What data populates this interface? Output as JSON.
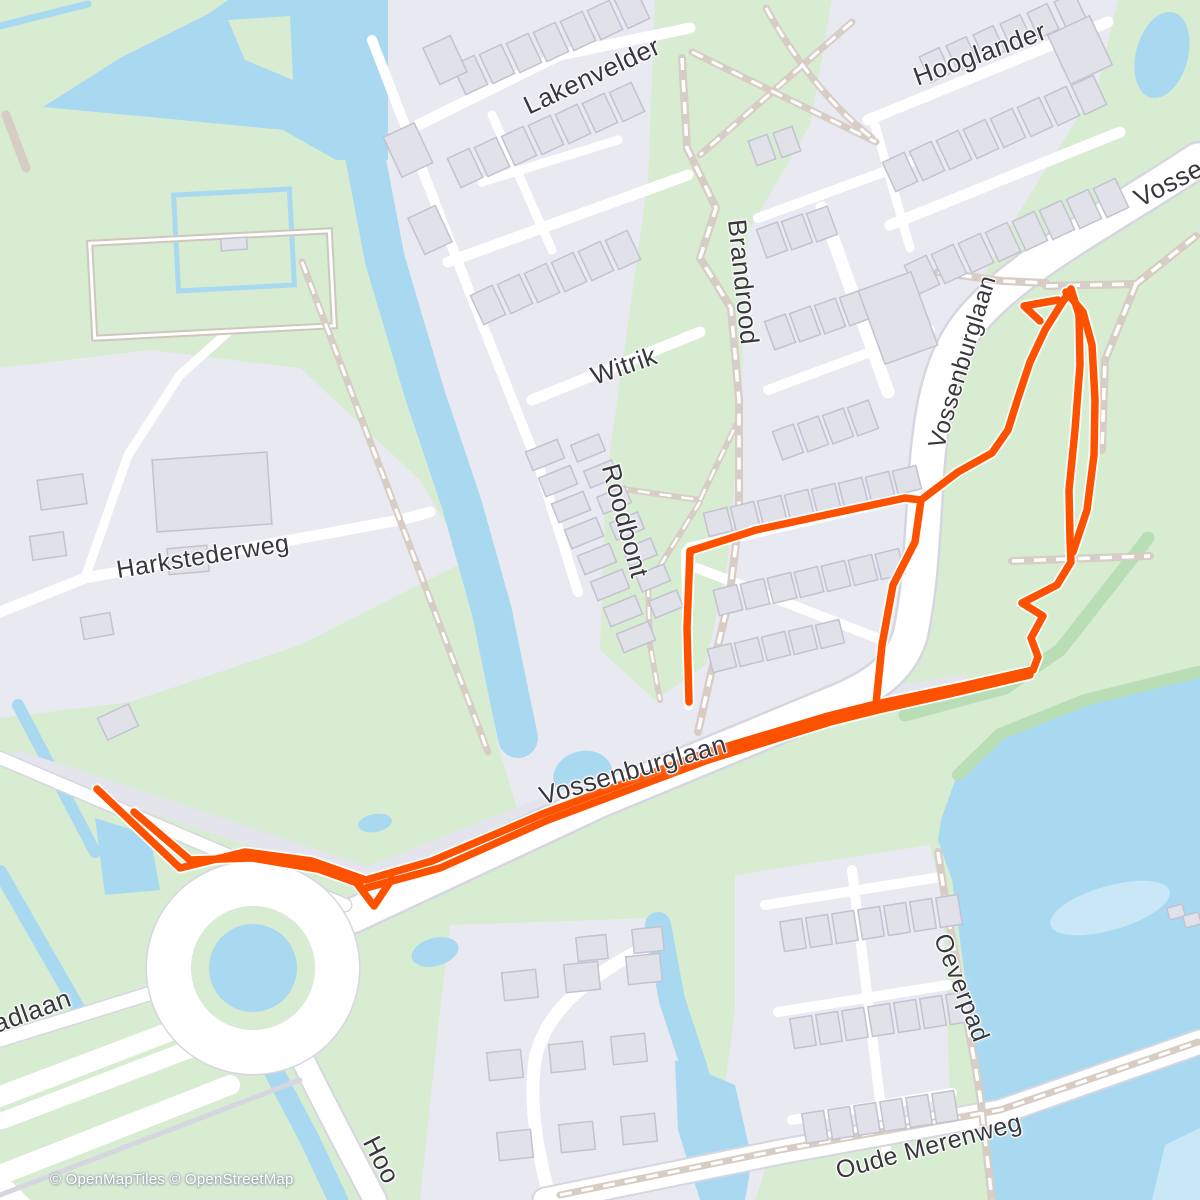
{
  "map": {
    "attribution": "© OpenMapTiles © OpenStreetMap",
    "labels": {
      "lakenvelder": "Lakenvelder",
      "hooglander": "Hooglander",
      "vossenburglaan_top": "Vossenburglaan",
      "brandrood": "Brandrood",
      "witrik": "Witrik",
      "vossenburglaan_mid": "Vossenburglaan",
      "roodbont": "Roodbont",
      "harkstederweg": "Harkstederweg",
      "vossenburglaan_main": "Vossenburglaan",
      "oeverpad": "Oeverpad",
      "oude_merenweg": "Oude Merenweg",
      "adlaan_partial": "adlaan",
      "hoofdweg_partial": "Hoo"
    },
    "palette": {
      "route": "#fc5200",
      "water": "#a9d9f0",
      "water_shallow": "#c9e7f6",
      "grass": "#d8ecd2",
      "residential": "#e9e9f2",
      "road": "#ffffff",
      "road_casing": "#d6d6e0",
      "path": "#d7cdc4",
      "label_text": "#37373d"
    }
  }
}
